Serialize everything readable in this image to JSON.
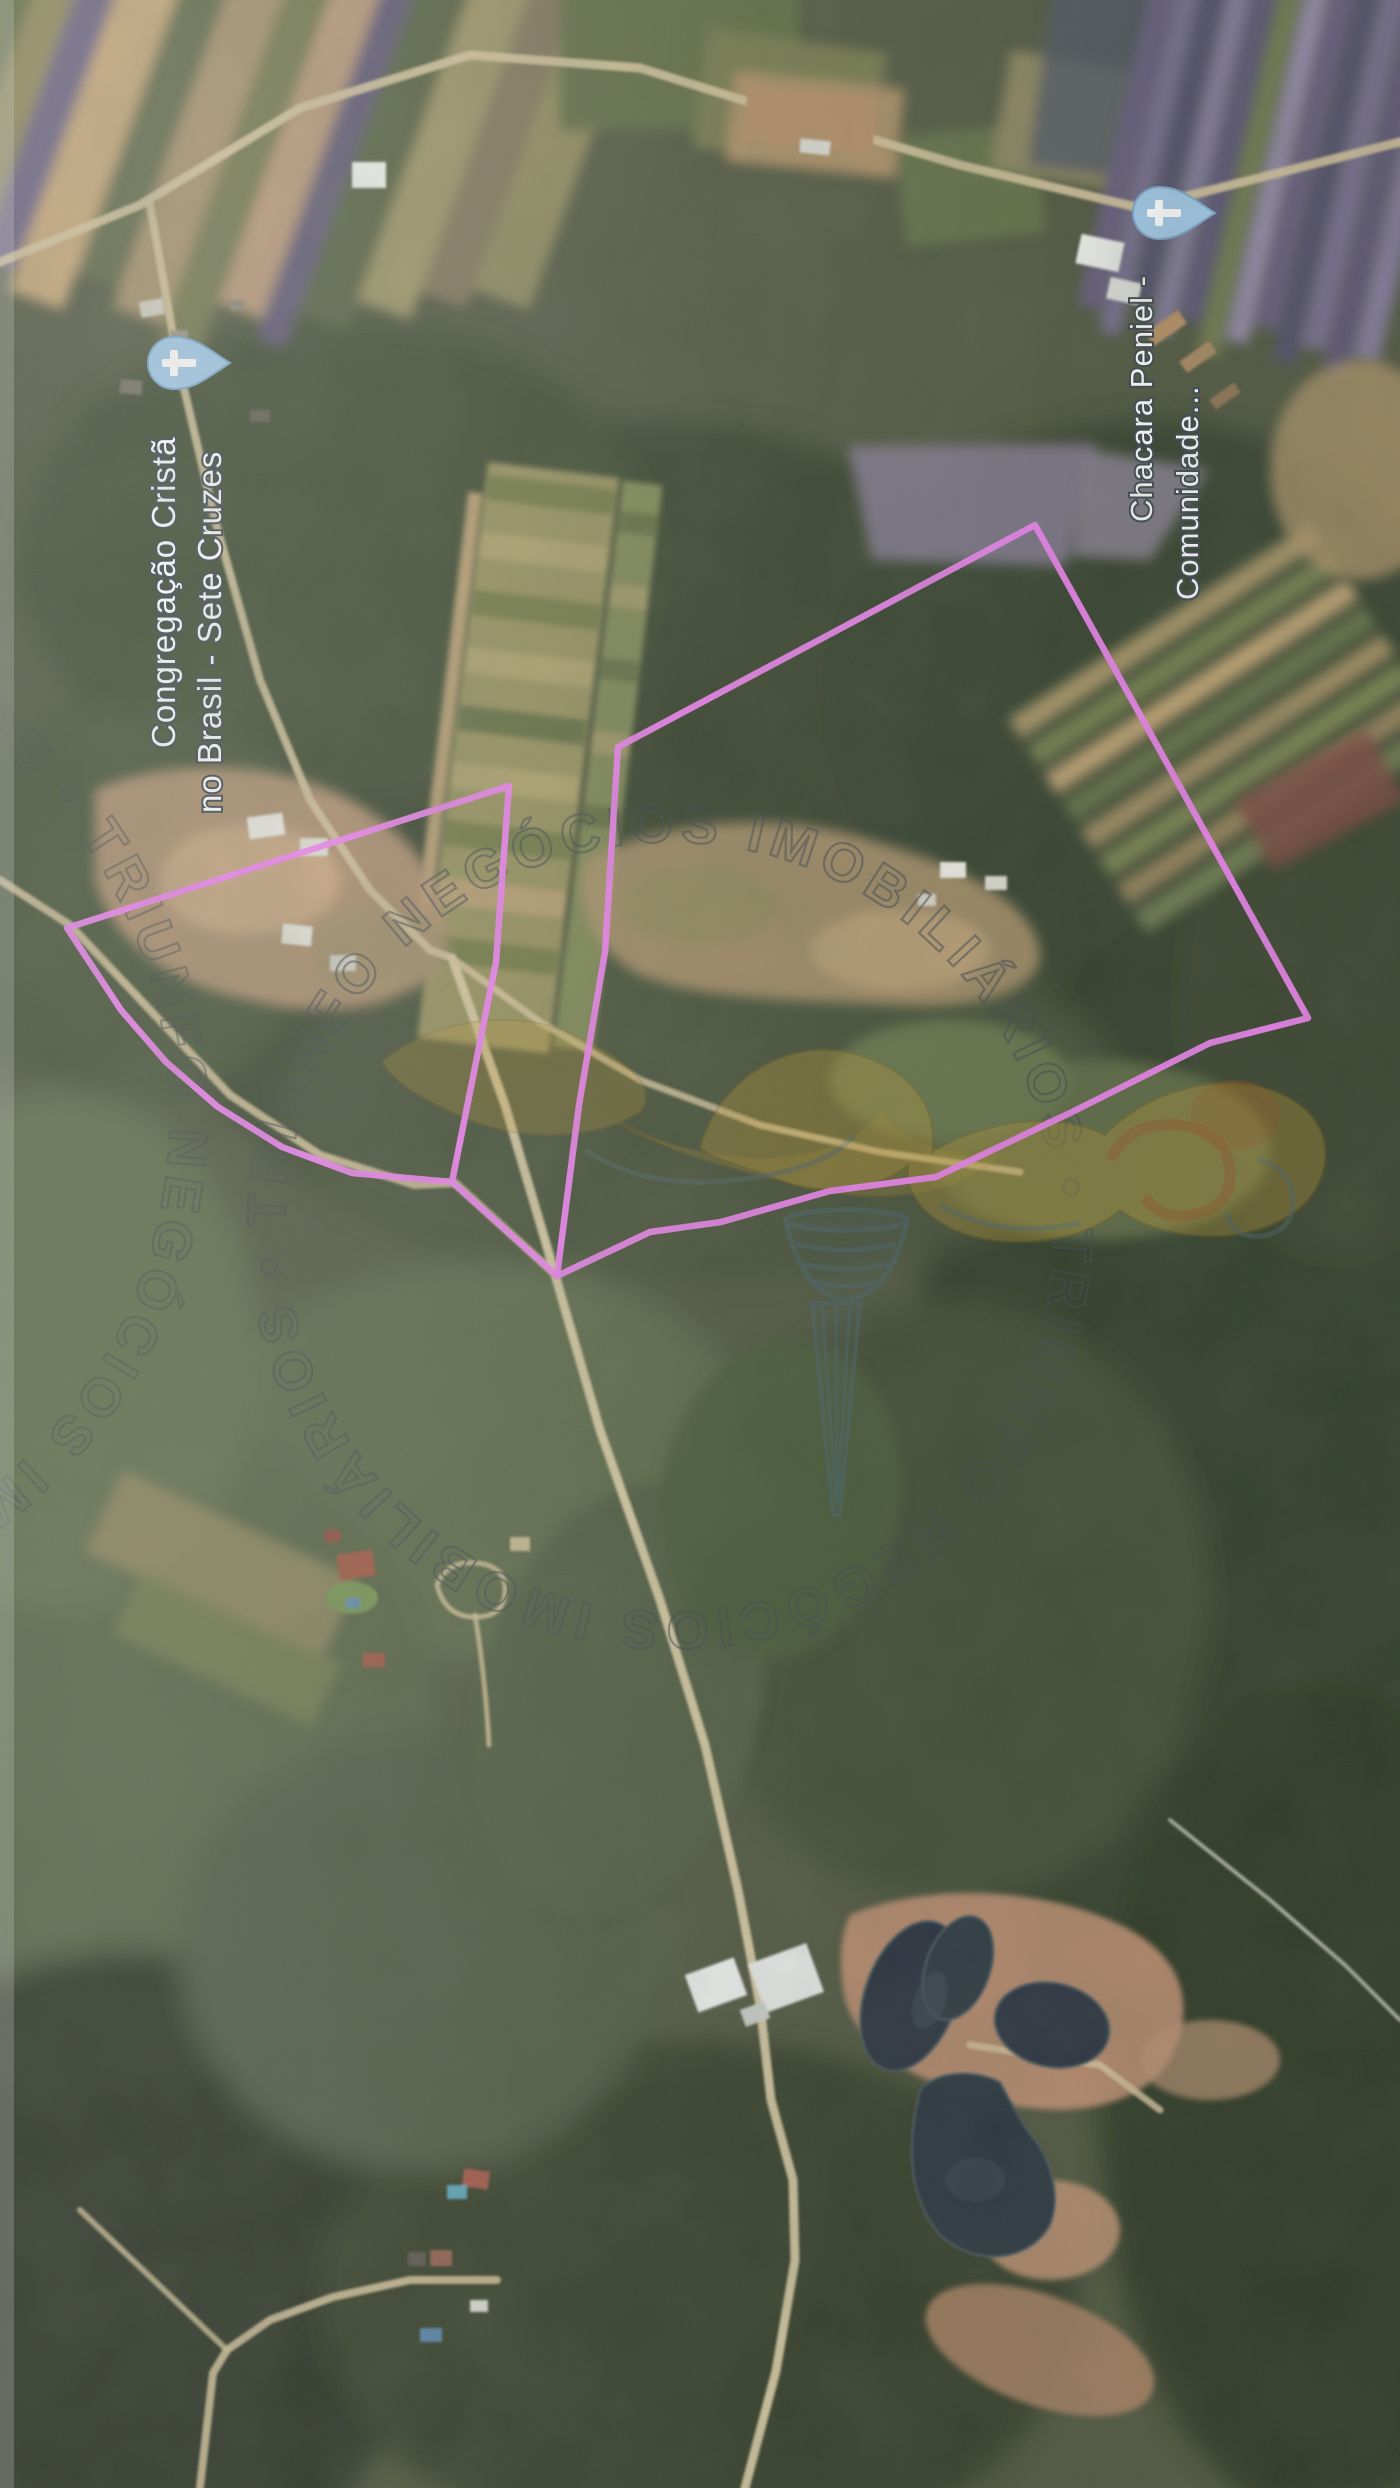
{
  "image": {
    "kind": "aerial-satellite-photo",
    "width": 1400,
    "height": 2488
  },
  "labels": {
    "church1": {
      "line1": "Congregação Cristã",
      "line2": "no Brasil - Sete Cruzes",
      "l1x": "175",
      "l1y": "748",
      "l1rot": "rotate(-90 175 748)",
      "l2x": "221",
      "l2y": "813",
      "l2rot": "rotate(-90 221 813)"
    },
    "church2": {
      "line1": "Chacara Peniel -",
      "line2": "Comunidade...",
      "l1x": "1152",
      "l1y": "522",
      "l1rot": "rotate(-90 1152 522)",
      "l2x": "1198",
      "l2y": "600",
      "l2rot": "rotate(-90 1198 600)"
    }
  },
  "pins": {
    "p1": {
      "transform": "translate(178 363) rotate(-90)",
      "fill": "#9ec7e8",
      "stroke": "#74a3c9"
    },
    "p2": {
      "transform": "translate(1163 213) rotate(-90)",
      "fill": "#9ec7e8",
      "stroke": "#74a3c9"
    }
  },
  "parcels": {
    "stroke": "#ee7ef0",
    "left_points": "509,786 496,962 452,1182 352,1173 282,1147 218,1107 166,1062 121,1010 67,928",
    "big_points": "1035,525 1308,1018 1210,1043 1072,1112 936,1177 830,1191 721,1222 650,1232 557,1276 579,1105 605,952 618,747",
    "connector_points": "452,1182 557,1276"
  },
  "watermark": {
    "ring_text": "TRIUNFO NEGÓCIOS IMOBILIÁRIOS • TRIUNFO NEGÓCIOS IMOBILIÁRIOS • ",
    "ring_text_left": "TRIUNFO NEGÓCIOS IMOBILIÁRIOS • TRIUNFO NEGÓCIOS IMOBILIÁRIOS • ",
    "color": "#3b424b"
  },
  "torch": {
    "gold": "#c59a2e",
    "gold_dark": "#8a6414",
    "red": "#b04a10",
    "teal": "#4e6a76"
  }
}
